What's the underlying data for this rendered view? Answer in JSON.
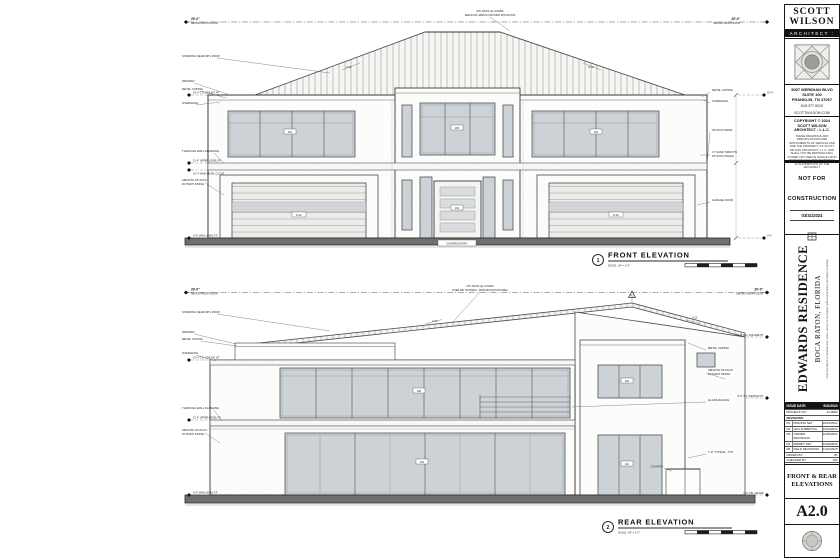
{
  "colors": {
    "ink": "#1a1a1a",
    "glass": "#ccd2d6",
    "ground": "#6f6f6c",
    "paper": "#ffffff"
  },
  "sheet": {
    "firm": {
      "name1": "SCOTT",
      "name2": "WILSON",
      "role": "ARCHITECT :",
      "address1": "5007 MERIDIAN BLVD",
      "address2": "SUITE 100",
      "address3": "FRANKLIN, TN 37067",
      "phone": "615.377.9010",
      "web": "SCOTTWILSON.COM",
      "copyright1": "COPYRIGHT © 2024",
      "copyright2": "SCOTT WILSON",
      "copyright3": "ARCHITECT : L.L.C.",
      "legal": "THESE DRAWINGS AND SPECIFICATIONS ARE INSTRUMENTS OF SERVICE AND ARE THE PROPERTY OF SCOTT WILSON ARCHITECT, L.L.C. AND SHALL NOT BE REPRODUCED, COPIED OR USED IN WHOLE OR IN PART WITHOUT PRIOR WRITTEN AUTHORIZATION OF THE ARCHITECT."
    },
    "status": {
      "line1": "NOT FOR",
      "line2": "CONSTRUCTION",
      "date": "03/31/2024"
    },
    "project": {
      "name": "EDWARDS RESIDENCE",
      "location": "BOCA RATON,  FLORIDA",
      "tagline": "Inspiring clients to achieve their vision using our God given gifts and timeless principles of design"
    },
    "table": {
      "issue_label": "ISSUE DATE:",
      "issue_value": "9/31/2024",
      "project_no_label": "PROJECT NO.:",
      "project_no_value": "24-0082",
      "revisions_label": "REVISIONS:",
      "rows": [
        {
          "no": "R1",
          "desc": "PRICING SET",
          "date": "10/15/2024"
        },
        {
          "no": "R2",
          "desc": "HOA SUBMITTAL",
          "date": "11/04/2024"
        },
        {
          "no": "R3",
          "desc": "OWNER REVISIONS",
          "date": "11/25/2024"
        },
        {
          "no": "R4",
          "desc": "PERMIT SET",
          "date": "12/18/2024"
        },
        {
          "no": "R5",
          "desc": "FIELD REVISIONS",
          "date": "01/22/2025"
        }
      ],
      "drawn_label": "DRAWN BY:",
      "drawn_value": "JD",
      "checked_label": "CHECKED BY:",
      "checked_value": "SW"
    },
    "title1": "FRONT & REAR",
    "title2": "ELEVATIONS",
    "number": "A2.0"
  },
  "front": {
    "num": "1",
    "title": "FRONT ELEVATION",
    "scale": "SCALE: 1/4\" = 1'-0\"",
    "dim": "29'-0\"",
    "dim_sub": "ABOVE FINISH FLOOR",
    "roof_note1": "MTL ROOF (2) LAYERS",
    "roof_note2": "SEE ROOF SPECS FOR WIND MITIGATION",
    "slope1": "3:12",
    "slope2": "3:12",
    "left": [
      "STANDING SEAM MTL ROOF",
      "PARAPET",
      "METAL COPING",
      "OVERHANG",
      "THROUGH WALL FLASHING",
      "SMOOTH STUCCO",
      "W/ PAINT FINISH"
    ],
    "right": [
      "METAL COPING",
      "OVERHANG",
      "STUCCO BAND",
      "LT. SAND SMOOTH",
      "STUCCO FINISH",
      "GARAGE DOOR"
    ],
    "levels": [
      "19'-4\" T.O. CEILING HT",
      "11'-4\" UPPER LEVEL F.F.",
      "10'-4\" MAIN LEVEL CLG HT",
      "0'-0\" MAIN LEVEL F.F."
    ],
    "rlevels": [
      "19'-4\"",
      "0'-0\""
    ],
    "entry_note": "COVERED ENTRY",
    "tags": {
      "w1": "204",
      "w2": "205",
      "w3": "206",
      "door": "100",
      "g1": "D-01",
      "g2": "D-02"
    }
  },
  "rear": {
    "num": "2",
    "title": "REAR ELEVATION",
    "scale": "SCALE: 1/4\" = 1'-0\"",
    "dim": "29'-0\"",
    "dim_sub": "ABOVE FINISH FLOOR",
    "roof_note1": "MTL ROOF (2) LAYERS",
    "roof_note2": "OVER WD TRUSSES - WIND MITIGATION AREA",
    "marker": "R2",
    "slope1": "2:12",
    "slope2": "3:12",
    "left": [
      "STANDING SEAM MTL ROOF",
      "PARAPET",
      "METAL COPING",
      "OVERHANG",
      "THROUGH WALL FLASHING",
      "SMOOTH STUCCO",
      "W/ PAINT FINISH"
    ],
    "right": [
      "METAL COPING",
      "SMOOTH STUCCO",
      "W/ PAINT FINISH",
      "GLASS RAILING",
      "7'-0\" TYPICAL, TYP.",
      "COUNTER"
    ],
    "levels": [
      "19'-4\" T.O. CEILING HT",
      "11'-4\" UPPER LEVEL F.F.",
      "0'-0\" MAIN LEVEL F.F."
    ],
    "rlevels": [
      "17'-4\" E.O. SQUARE HT",
      "8'-0\" T.O. WINDOW HT",
      "0'-0\" FIN. GRADE"
    ],
    "tags": {
      "u1": "208",
      "u2": "210",
      "d1": "104",
      "d2": "110"
    }
  }
}
